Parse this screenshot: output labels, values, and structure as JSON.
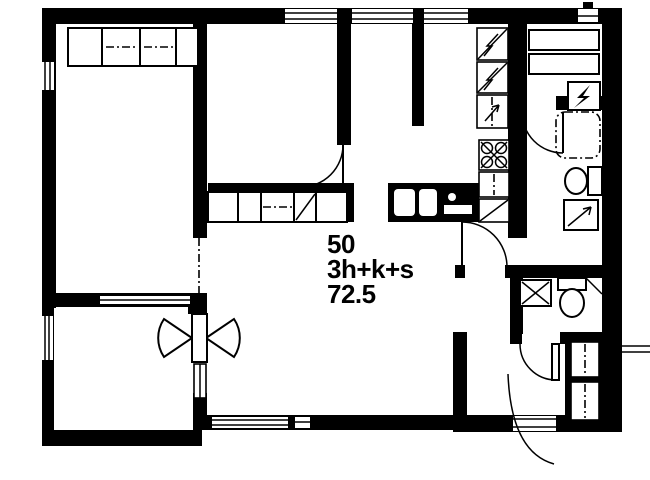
{
  "page": {
    "background_color": "#ffffff",
    "line_color": "#000000"
  },
  "plan": {
    "unit_number": "50",
    "unit_type": "3h+k+s",
    "area_m2": "72.5"
  },
  "icons": [
    {
      "name": "wardrobe-icon",
      "shape": "rect-with-dash-dot-line"
    },
    {
      "name": "fridge-freezer-icon",
      "shape": "rect-with-diagonal-lightning"
    },
    {
      "name": "oven-cabinet-icon",
      "shape": "rect-with-arrow"
    },
    {
      "name": "stove-icon",
      "shape": "rect-with-four-crossed-burners"
    },
    {
      "name": "kitchen-sink-icon",
      "shape": "black-counter-with-white-bowls"
    },
    {
      "name": "sauna-heater-icon",
      "shape": "rect-with-lightning-bolt"
    },
    {
      "name": "sauna-bench-icon",
      "shape": "horizontal-rects"
    },
    {
      "name": "shower-icon",
      "shape": "dash-dot-rounded-square"
    },
    {
      "name": "toilet-icon",
      "shape": "oval-bowl-with-tank"
    },
    {
      "name": "washing-machine-icon",
      "shape": "rect-with-diagonal-arrow"
    },
    {
      "name": "door-swing-icon",
      "shape": "quarter-circle-arc"
    },
    {
      "name": "balcony-double-door-icon",
      "shape": "bowtie-double-swing"
    },
    {
      "name": "window-icon",
      "shape": "double-line-in-wall"
    }
  ]
}
